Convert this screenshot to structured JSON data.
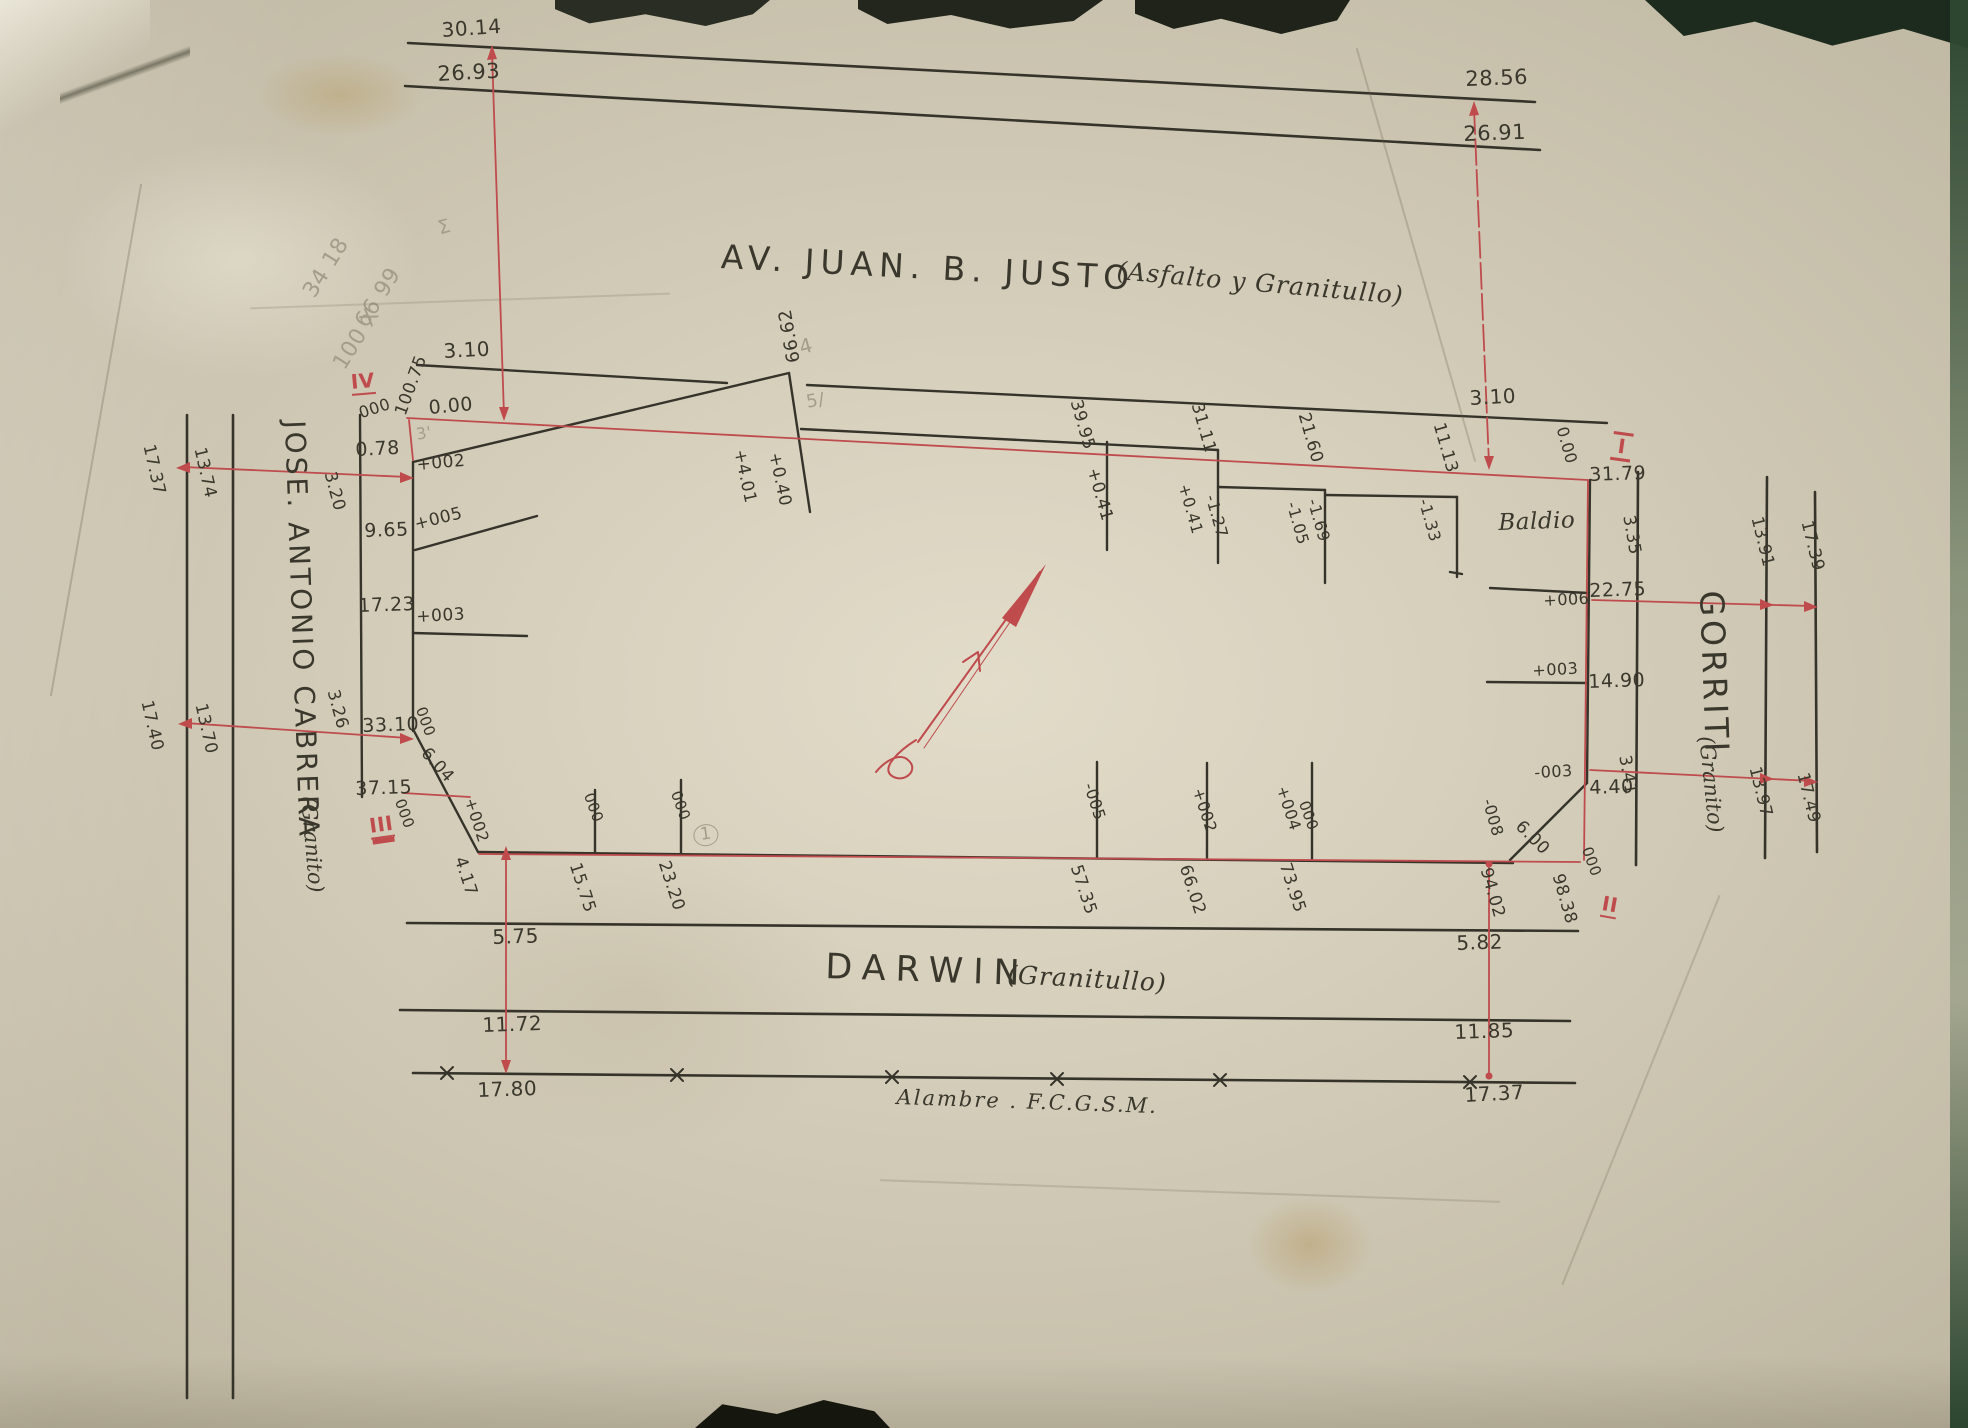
{
  "colors": {
    "paper": "#d8d1bd",
    "ink": "#3a372c",
    "red": "#bf4b4d",
    "pencil": "#a39d8a"
  },
  "streets": {
    "top": {
      "name": "AV. JUAN. B. JUSTO",
      "surface": "(Asfalto y Granitullo)"
    },
    "bottom": {
      "name": "DARWIN",
      "surface": "(Granitullo)"
    },
    "left": {
      "name": "JOSE. ANTONIO CABRERA",
      "surface": "(Granito)"
    },
    "right": {
      "name": "GORRITI",
      "surface": "(Granito)"
    }
  },
  "fence_label": "Alambre . F.C.G.S.M.",
  "corner_markers": [
    "I",
    "II",
    "III",
    "IV"
  ],
  "labels": [
    {
      "t": "30.14",
      "x": 441,
      "y": 20,
      "r": -4,
      "s": 20,
      "n": "dim-top-30-14"
    },
    {
      "t": "26.93",
      "x": 437,
      "y": 64,
      "r": -3,
      "s": 21,
      "n": "dim-top-26-93"
    },
    {
      "t": "28.56",
      "x": 1465,
      "y": 69,
      "r": -2,
      "s": 21,
      "n": "dim-top-28-56"
    },
    {
      "t": "26.91",
      "x": 1463,
      "y": 124,
      "r": -2,
      "s": 21,
      "n": "dim-top-26-91"
    },
    {
      "t": "3.10",
      "x": 443,
      "y": 341,
      "r": -3,
      "s": 20,
      "n": "dim-3-10-left"
    },
    {
      "t": "100.75",
      "x": 393,
      "y": 412,
      "r": -70,
      "s": 17,
      "n": "dim-100-75"
    },
    {
      "t": "000",
      "x": 357,
      "y": 406,
      "r": -18,
      "s": 16
    },
    {
      "t": "0.00",
      "x": 428,
      "y": 399,
      "r": -5,
      "s": 19,
      "n": "datum-0-00-left"
    },
    {
      "t": "0.78",
      "x": 355,
      "y": 441,
      "r": -3,
      "s": 19
    },
    {
      "t": "+002",
      "x": 416,
      "y": 457,
      "r": -5,
      "s": 17
    },
    {
      "t": "3.20",
      "x": 337,
      "y": 470,
      "r": 75,
      "s": 17
    },
    {
      "t": "9.65",
      "x": 364,
      "y": 522,
      "r": -2,
      "s": 19
    },
    {
      "t": "+005",
      "x": 413,
      "y": 517,
      "r": -14,
      "s": 17
    },
    {
      "t": "17.23",
      "x": 358,
      "y": 597,
      "r": -2,
      "s": 19
    },
    {
      "t": "+003",
      "x": 416,
      "y": 609,
      "r": -3,
      "s": 17
    },
    {
      "t": "3.26",
      "x": 340,
      "y": 688,
      "r": 75,
      "s": 17
    },
    {
      "t": "33.10",
      "x": 362,
      "y": 717,
      "r": -2,
      "s": 19
    },
    {
      "t": "000",
      "x": 427,
      "y": 705,
      "r": 70,
      "s": 15
    },
    {
      "t": "6.04",
      "x": 430,
      "y": 745,
      "r": 48,
      "s": 17
    },
    {
      "t": "37.15",
      "x": 355,
      "y": 780,
      "r": -2,
      "s": 19
    },
    {
      "t": "000",
      "x": 406,
      "y": 797,
      "r": 70,
      "s": 15
    },
    {
      "t": "+002",
      "x": 477,
      "y": 796,
      "r": 72,
      "s": 16
    },
    {
      "t": "4.17",
      "x": 467,
      "y": 855,
      "r": 72,
      "s": 17
    },
    {
      "t": "17.37",
      "x": 156,
      "y": 443,
      "r": 77,
      "s": 17,
      "n": "dim-cabrera-17-37"
    },
    {
      "t": "13.74",
      "x": 207,
      "y": 446,
      "r": 77,
      "s": 17,
      "n": "dim-cabrera-13-74"
    },
    {
      "t": "17.40",
      "x": 154,
      "y": 699,
      "r": 77,
      "s": 17,
      "n": "dim-cabrera-17-40"
    },
    {
      "t": "13.70",
      "x": 208,
      "y": 702,
      "r": 77,
      "s": 17,
      "n": "dim-cabrera-13-70"
    },
    {
      "t": "66.62",
      "x": 786,
      "y": 364,
      "r": -100,
      "s": 18,
      "n": "dim-66-62"
    },
    {
      "t": "4",
      "x": 797,
      "y": 338,
      "r": -15,
      "s": 20,
      "c": "pencil"
    },
    {
      "t": "5/",
      "x": 805,
      "y": 394,
      "r": -10,
      "s": 18,
      "c": "pencil"
    },
    {
      "t": "3'",
      "x": 415,
      "y": 427,
      "r": -10,
      "s": 16,
      "c": "pencil"
    },
    {
      "t": "+4.01",
      "x": 747,
      "y": 448,
      "r": 78,
      "s": 17
    },
    {
      "t": "+0.40",
      "x": 782,
      "y": 451,
      "r": 78,
      "s": 17
    },
    {
      "t": "39.95",
      "x": 1083,
      "y": 398,
      "r": 74,
      "s": 17
    },
    {
      "t": "+0.41",
      "x": 1100,
      "y": 466,
      "r": 74,
      "s": 17
    },
    {
      "t": "31.11",
      "x": 1204,
      "y": 401,
      "r": 74,
      "s": 17
    },
    {
      "t": "+0.41",
      "x": 1191,
      "y": 482,
      "r": 74,
      "s": 16
    },
    {
      "t": "-1.27",
      "x": 1218,
      "y": 493,
      "r": 74,
      "s": 16
    },
    {
      "t": "21.60",
      "x": 1311,
      "y": 411,
      "r": 74,
      "s": 17
    },
    {
      "t": "-1.05",
      "x": 1299,
      "y": 500,
      "r": 74,
      "s": 16
    },
    {
      "t": "-1.69",
      "x": 1320,
      "y": 497,
      "r": 74,
      "s": 16
    },
    {
      "t": "11.13",
      "x": 1446,
      "y": 421,
      "r": 74,
      "s": 17
    },
    {
      "t": "-1.33",
      "x": 1431,
      "y": 497,
      "r": 74,
      "s": 16
    },
    {
      "t": "3.10",
      "x": 1469,
      "y": 388,
      "r": -3,
      "s": 20,
      "n": "dim-3-10-right"
    },
    {
      "t": "0.00",
      "x": 1569,
      "y": 425,
      "r": 74,
      "s": 16,
      "n": "datum-0-00-right"
    },
    {
      "t": "31.79",
      "x": 1589,
      "y": 466,
      "r": -2,
      "s": 19
    },
    {
      "t": "Baldio",
      "x": 1498,
      "y": 512,
      "r": -2,
      "s": 23,
      "f": "script",
      "n": "baldio-label"
    },
    {
      "t": "3.35",
      "x": 1636,
      "y": 514,
      "r": 80,
      "s": 17
    },
    {
      "t": "+006",
      "x": 1543,
      "y": 593,
      "r": -3,
      "s": 16
    },
    {
      "t": "22.75",
      "x": 1589,
      "y": 582,
      "r": -2,
      "s": 19
    },
    {
      "t": "+003",
      "x": 1532,
      "y": 663,
      "r": -3,
      "s": 16
    },
    {
      "t": "14.90",
      "x": 1588,
      "y": 673,
      "r": -2,
      "s": 19
    },
    {
      "t": "-003",
      "x": 1534,
      "y": 765,
      "r": -3,
      "s": 16
    },
    {
      "t": "4.40",
      "x": 1589,
      "y": 779,
      "r": -2,
      "s": 19
    },
    {
      "t": "3.41",
      "x": 1632,
      "y": 754,
      "r": 80,
      "s": 17
    },
    {
      "t": "-008",
      "x": 1495,
      "y": 797,
      "r": 74,
      "s": 16
    },
    {
      "t": "6.00",
      "x": 1524,
      "y": 818,
      "r": 45,
      "s": 17
    },
    {
      "t": "000",
      "x": 1593,
      "y": 845,
      "r": 70,
      "s": 15
    },
    {
      "t": "94.02",
      "x": 1493,
      "y": 866,
      "r": 74,
      "s": 17
    },
    {
      "t": "98.38",
      "x": 1565,
      "y": 872,
      "r": 74,
      "s": 17
    },
    {
      "t": "13.91",
      "x": 1764,
      "y": 515,
      "r": 76,
      "s": 17,
      "n": "dim-gorriti-13-91"
    },
    {
      "t": "17.39",
      "x": 1814,
      "y": 519,
      "r": 76,
      "s": 17,
      "n": "dim-gorriti-17-39"
    },
    {
      "t": "13.97",
      "x": 1762,
      "y": 765,
      "r": 76,
      "s": 17,
      "n": "dim-gorriti-13-97"
    },
    {
      "t": "17.49",
      "x": 1810,
      "y": 771,
      "r": 76,
      "s": 17,
      "n": "dim-gorriti-17-49"
    },
    {
      "t": "000",
      "x": 595,
      "y": 791,
      "r": 70,
      "s": 15
    },
    {
      "t": "15.75",
      "x": 582,
      "y": 861,
      "r": 72,
      "s": 17
    },
    {
      "t": "000",
      "x": 682,
      "y": 789,
      "r": 70,
      "s": 15
    },
    {
      "t": "23.20",
      "x": 671,
      "y": 859,
      "r": 72,
      "s": 17
    },
    {
      "t": "1",
      "x": 692,
      "y": 826,
      "r": -8,
      "s": 17,
      "c": "pencil",
      "u": "circ"
    },
    {
      "t": "-005",
      "x": 1096,
      "y": 781,
      "r": 72,
      "s": 16
    },
    {
      "t": "57.35",
      "x": 1083,
      "y": 863,
      "r": 72,
      "s": 17
    },
    {
      "t": "+002",
      "x": 1205,
      "y": 786,
      "r": 72,
      "s": 16
    },
    {
      "t": "66.02",
      "x": 1192,
      "y": 863,
      "r": 72,
      "s": 17
    },
    {
      "t": "+004",
      "x": 1289,
      "y": 784,
      "r": 72,
      "s": 16
    },
    {
      "t": "000",
      "x": 1310,
      "y": 799,
      "r": 70,
      "s": 15
    },
    {
      "t": "73.95",
      "x": 1292,
      "y": 861,
      "r": 72,
      "s": 17
    },
    {
      "t": "5.75",
      "x": 492,
      "y": 927,
      "r": -2,
      "s": 20,
      "n": "dim-darwin-5-75"
    },
    {
      "t": "11.72",
      "x": 482,
      "y": 1015,
      "r": -2,
      "s": 20,
      "n": "dim-darwin-11-72"
    },
    {
      "t": "17.80",
      "x": 477,
      "y": 1080,
      "r": -2,
      "s": 20,
      "n": "dim-darwin-17-80"
    },
    {
      "t": "5.82",
      "x": 1456,
      "y": 933,
      "r": -2,
      "s": 20,
      "n": "dim-darwin-5-82"
    },
    {
      "t": "11.85",
      "x": 1454,
      "y": 1022,
      "r": -2,
      "s": 20,
      "n": "dim-darwin-11-85"
    },
    {
      "t": "17.37",
      "x": 1464,
      "y": 1085,
      "r": -3,
      "s": 20,
      "n": "dim-darwin-17-37"
    },
    {
      "t": "IV",
      "x": 350,
      "y": 372,
      "r": -5,
      "s": 20,
      "c": "red",
      "u": "u1",
      "n": "corner-marker-iv"
    },
    {
      "t": "III",
      "x": 368,
      "y": 816,
      "r": -8,
      "s": 20,
      "c": "red",
      "u": "u2",
      "n": "corner-marker-iii"
    },
    {
      "t": "II",
      "x": 1604,
      "y": 893,
      "r": 10,
      "s": 20,
      "c": "red",
      "u": "u1",
      "n": "corner-marker-ii"
    },
    {
      "t": "I",
      "x": 1614,
      "y": 431,
      "r": 8,
      "s": 20,
      "c": "red",
      "u": "bars",
      "n": "corner-marker-i"
    },
    {
      "t": "34 18",
      "x": 300,
      "y": 290,
      "r": -58,
      "s": 22,
      "c": "pencil",
      "n": "pencil-note"
    },
    {
      "t": "66 99",
      "x": 352,
      "y": 320,
      "r": -58,
      "s": 22,
      "c": "pencil",
      "n": "pencil-note"
    },
    {
      "t": "100 X",
      "x": 330,
      "y": 362,
      "r": -58,
      "s": 22,
      "c": "pencil",
      "n": "pencil-note"
    },
    {
      "t": "Σ",
      "x": 436,
      "y": 220,
      "r": -15,
      "s": 19,
      "c": "pencil",
      "n": "pencil-note"
    }
  ]
}
